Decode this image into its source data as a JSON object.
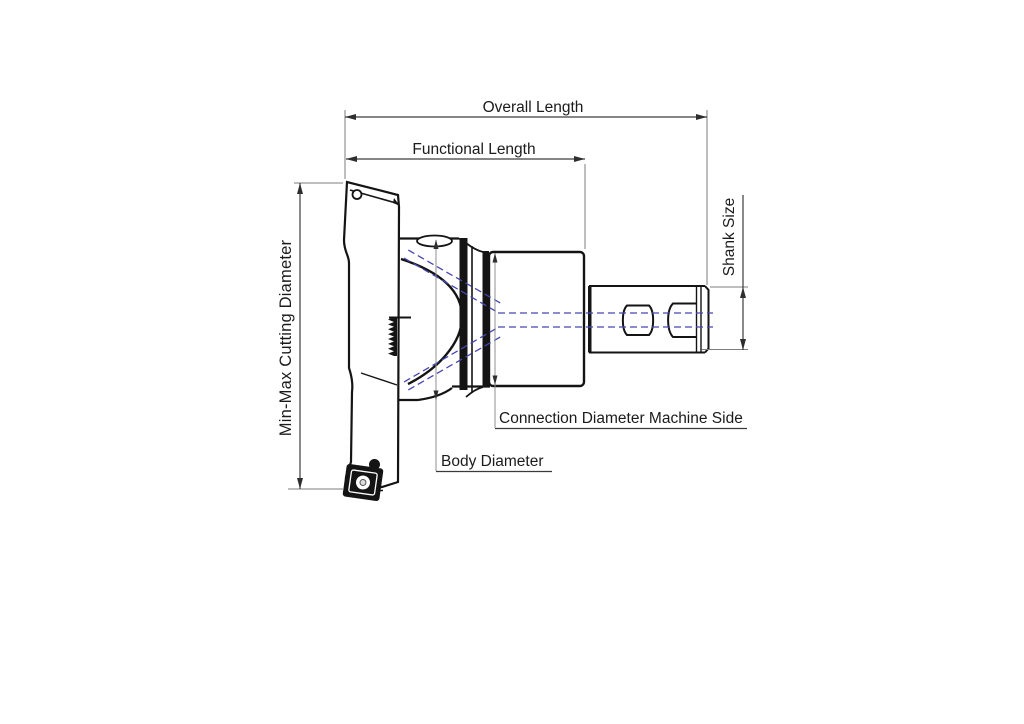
{
  "diagram": {
    "labels": {
      "overall_length": "Overall Length",
      "functional_length": "Functional Length",
      "min_max_cutting_diameter": "Min-Max Cutting Diameter",
      "shank_size": "Shank Size",
      "connection_diameter_machine_side": "Connection Diameter Machine Side",
      "body_diameter": "Body Diameter"
    },
    "colors": {
      "ink": "#141414",
      "dimension_line": "#3d3d3d",
      "extension_line": "#7d7d7d",
      "coolant_centerline": "#4646b4",
      "background": "#ffffff"
    }
  }
}
